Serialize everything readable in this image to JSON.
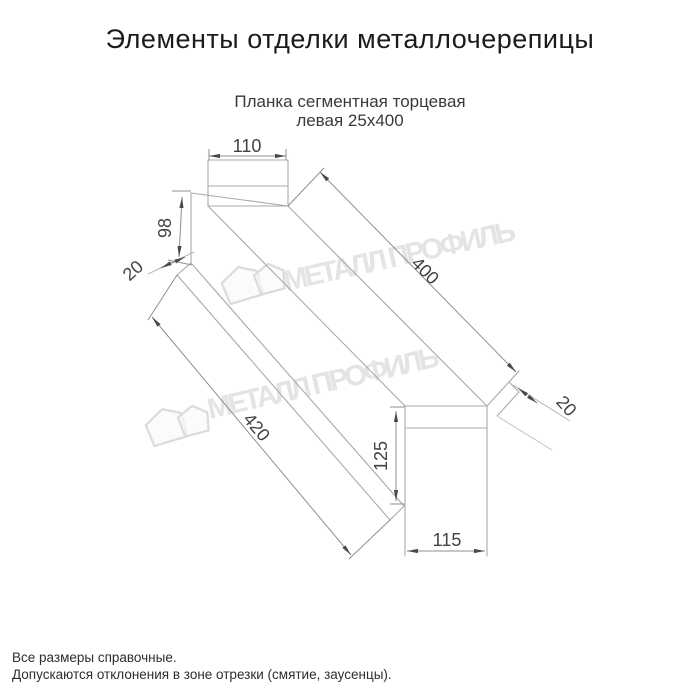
{
  "page": {
    "title": "Элементы отделки металлочерепицы",
    "product": {
      "line1": "Планка сегментная торцевая",
      "line2": "левая 25х400"
    },
    "dimensions": {
      "top_flange_width": "110",
      "left_end_height": "98",
      "left_hem": "20",
      "top_edge_length": "400",
      "bottom_edge_length": "420",
      "right_hem": "20",
      "right_end_height": "125",
      "right_end_width": "115"
    },
    "watermark": {
      "text": "МЕТАЛЛ ПРОФИЛЬ"
    },
    "footnotes": {
      "line1": "Все размеры справочные.",
      "line2": "Допускаются отклонения в зоне отрезки (смятие, заусенцы)."
    },
    "colors": {
      "title_text": "#1b1b1b",
      "subtitle_text": "#3a3a3a",
      "drawing_line": "#a9a9a9",
      "dimension_line": "#8f8f8f",
      "dimension_text": "#424242",
      "arrow": "#4a4a4a",
      "watermark": "#e3e3e3",
      "background": "#ffffff"
    }
  }
}
